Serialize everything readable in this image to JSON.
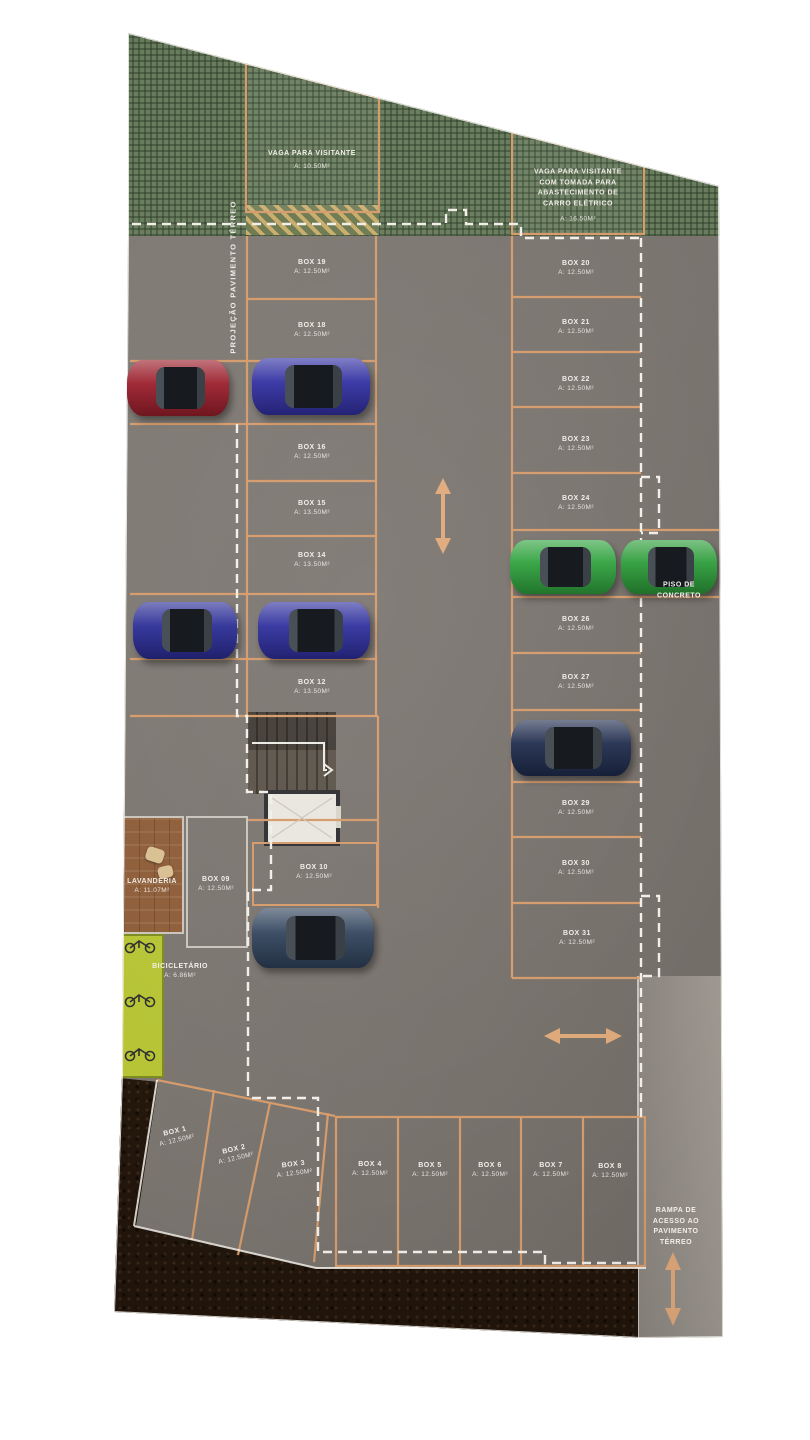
{
  "plan": {
    "side_label": "PROJEÇÃO PAVIMENTO TÉRREO",
    "piso_label": "PISO DE CONCRETO",
    "ramp_label": "RAMPA DE ACESSO AO PAVIMENTO TÉRREO",
    "visitor_spots": [
      {
        "label": "VAGA PARA VISITANTE",
        "area": "A: 10.50m²"
      },
      {
        "label": "VAGA PARA VISITANTE COM TOMADA PARA ABASTECIMENTO DE CARRO ELÉTRICO",
        "area": "A: 16.50m²"
      }
    ],
    "rooms": [
      {
        "label": "LAVANDERIA",
        "area": "A: 11.07m²"
      },
      {
        "label": "BICICLETÁRIO",
        "area": "A: 6.86m²"
      }
    ],
    "left_boxes": [
      {
        "label": "BOX 19",
        "area": "A: 12.50m²"
      },
      {
        "label": "BOX 18",
        "area": "A: 12.50m²"
      },
      {
        "label": "BOX 16",
        "area": "A: 12.50m²"
      },
      {
        "label": "BOX 15",
        "area": "A: 13.50m²"
      },
      {
        "label": "BOX 14",
        "area": "A: 13.50m²"
      },
      {
        "label": "BOX 12",
        "area": "A: 13.50m²"
      }
    ],
    "right_boxes": [
      {
        "label": "BOX 20",
        "area": "A: 12.50m²"
      },
      {
        "label": "BOX 21",
        "area": "A: 12.50m²"
      },
      {
        "label": "BOX 22",
        "area": "A: 12.50m²"
      },
      {
        "label": "BOX 23",
        "area": "A: 12.50m²"
      },
      {
        "label": "BOX 24",
        "area": "A: 12.50m²"
      },
      {
        "label": "BOX 26",
        "area": "A: 12.50m²"
      },
      {
        "label": "BOX 27",
        "area": "A: 12.50m²"
      },
      {
        "label": "BOX 29",
        "area": "A: 12.50m²"
      },
      {
        "label": "BOX 30",
        "area": "A: 12.50m²"
      },
      {
        "label": "BOX 31",
        "area": "A: 12.50m²"
      }
    ],
    "mid_boxes": [
      {
        "label": "BOX 09",
        "area": "A: 12.50m²"
      },
      {
        "label": "BOX 10",
        "area": "A: 12.50m²"
      }
    ],
    "bottom_boxes": [
      {
        "label": "BOX 1",
        "area": "A: 12.50m²"
      },
      {
        "label": "BOX 2",
        "area": "A: 12.50m²"
      },
      {
        "label": "BOX 3",
        "area": "A: 12.50m²"
      },
      {
        "label": "BOX 4",
        "area": "A: 12.50m²"
      },
      {
        "label": "BOX 5",
        "area": "A: 12.50m²"
      },
      {
        "label": "BOX 6",
        "area": "A: 12.50m²"
      },
      {
        "label": "BOX 7",
        "area": "A: 12.50m²"
      },
      {
        "label": "BOX 8",
        "area": "A: 12.50m²"
      }
    ],
    "cars": [
      {
        "name": "red-car",
        "color": "#9a1e2b"
      },
      {
        "name": "blue-car-1",
        "color": "#3230a2"
      },
      {
        "name": "blue-car-2",
        "color": "#2b2d96"
      },
      {
        "name": "blue-car-3",
        "color": "#2f2f9e"
      },
      {
        "name": "green-car-1",
        "color": "#2fa23d"
      },
      {
        "name": "green-car-2",
        "color": "#2c9c39"
      },
      {
        "name": "navy-car",
        "color": "#1f2c4d"
      },
      {
        "name": "steel-blue-car",
        "color": "#31435c"
      }
    ],
    "colors": {
      "orange_line": "#d59b6b",
      "dashed_white": "#f2efe9",
      "floor_gray": "#7b7571",
      "landscape_green": "#697c5d",
      "bike_lime": "#b6c435",
      "soil_brown": "#281a10",
      "wood_brown": "#8f5e3a"
    }
  }
}
